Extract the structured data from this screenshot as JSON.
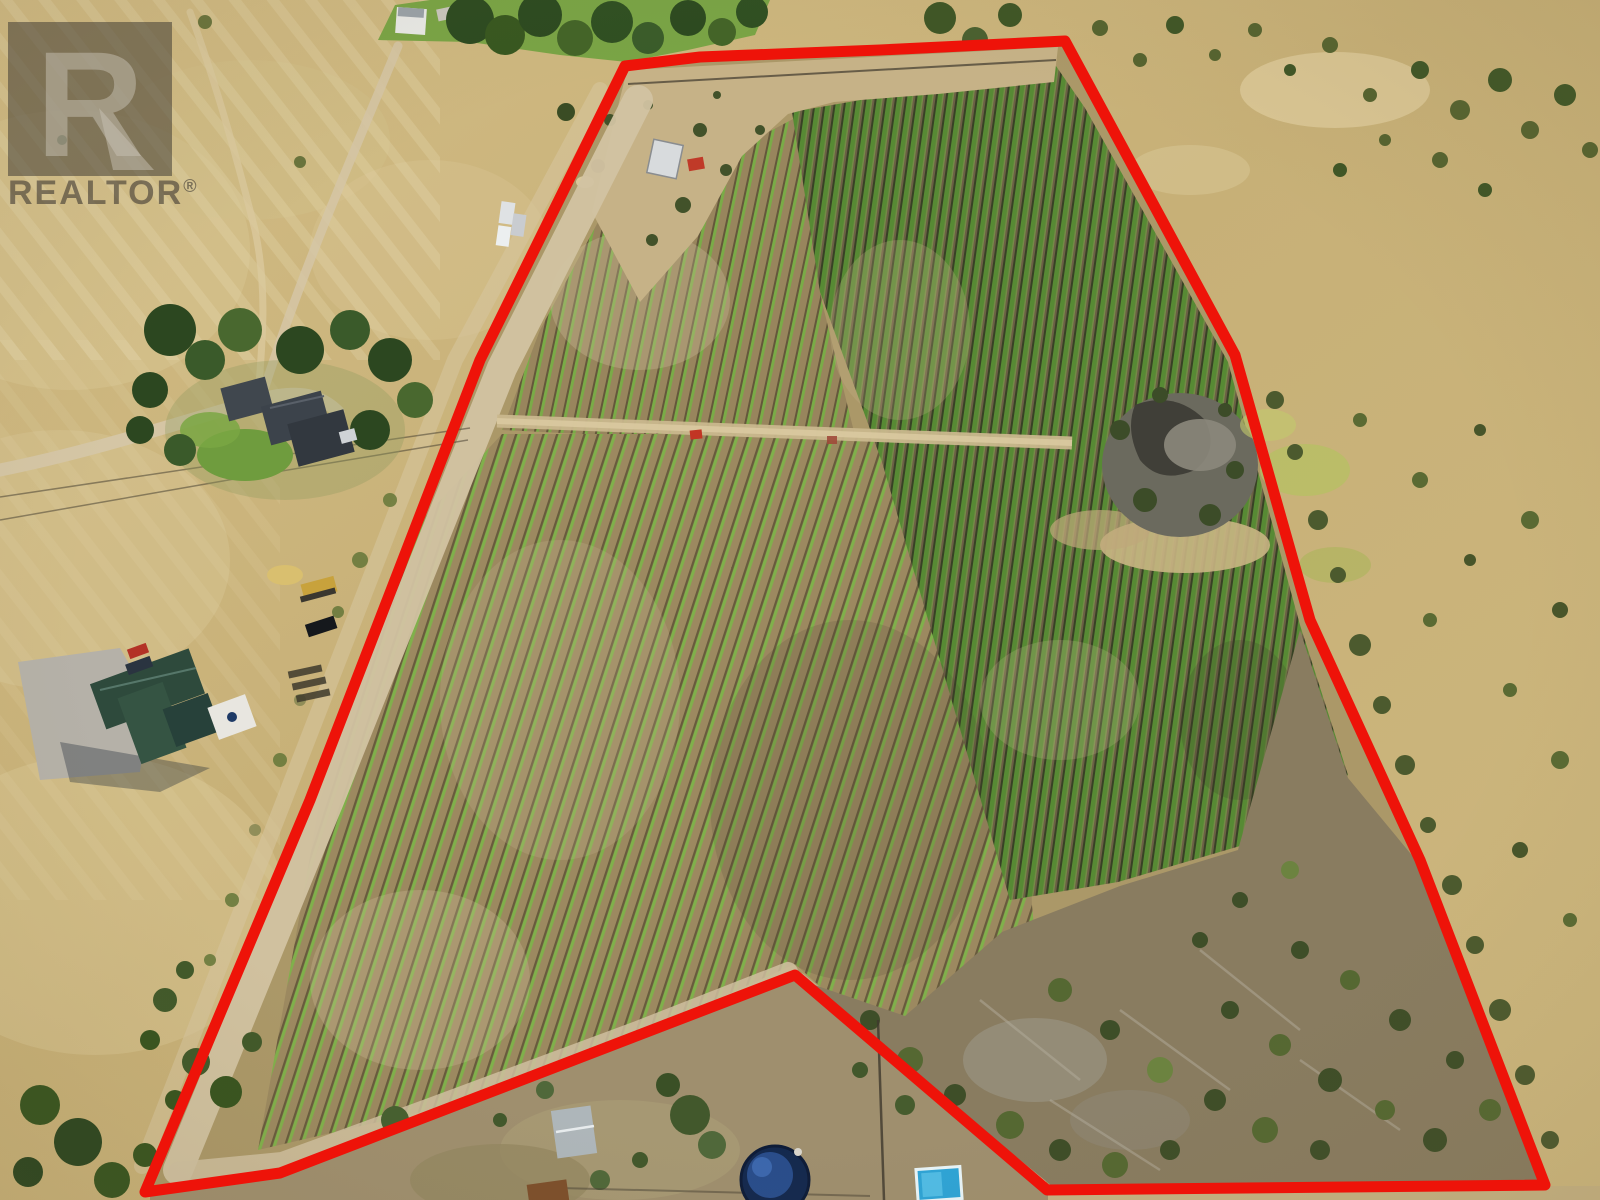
{
  "image": {
    "type": "aerial-real-estate-photo",
    "description": "Drone aerial view of a rural vineyard acreage outlined with a red property boundary, REALTOR watermark top-left",
    "width": 1600,
    "height": 1200
  },
  "watermark": {
    "logo_letter": "R",
    "label": "REALTOR",
    "reg": "®"
  },
  "boundary": {
    "color": "#ee1309",
    "stroke_width": 11,
    "points": "625,66 700,57 880,50 1065,41 1235,355 1310,620 1420,860 1545,1185 1047,1190 795,975 280,1173 145,1192 310,800 480,360"
  },
  "palette": {
    "dry_grass": "#cdb77e",
    "lawn_green": "#79a445",
    "vine_green": "#6aa13f",
    "soil_brown": "#9c8960",
    "tree_green": "#3a5a2a",
    "rock_gray": "#6b6a5e",
    "road_tan": "#d2c3a2",
    "pool_navy": "#14294e",
    "pool_cyan": "#2ea4d6",
    "log_house_roof": "#2e4a3c",
    "shed_roof_gray": "#aeb6ba",
    "watermark_gray": "rgba(58,54,48,0.52)"
  },
  "landmarks": [
    "vineyard rows",
    "inner farm road",
    "mid-field dirt path",
    "rock outcrop",
    "neighbor main house",
    "log house",
    "travel trailer",
    "round above-ground pool",
    "rectangular pool",
    "garden shed"
  ]
}
